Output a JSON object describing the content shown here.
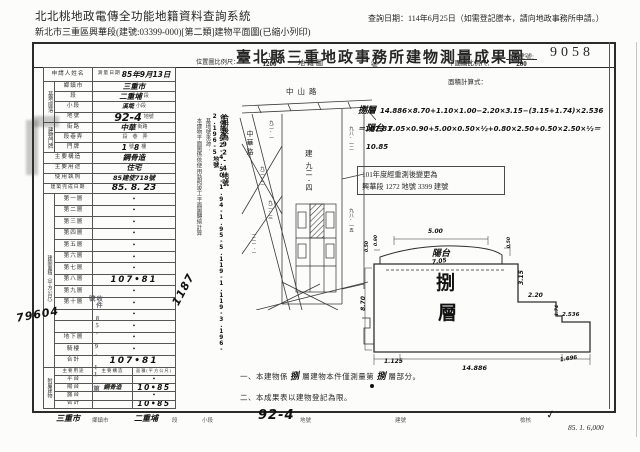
{
  "header": {
    "system_title": "北北桃地政電傳全功能地籍資料查詢系統",
    "query_date": "查詢日期：114年6月25日（如需登記謄本，請向地政事務所申請。）",
    "doc_line": "新北市三重區興華段(建號:03399-000)[第二類]建物平面圖(已縮小列印)"
  },
  "title_bar": {
    "title": "臺北縣三重地政事務所建物測量成果圖",
    "building_no_label": "建號:",
    "building_no": "9058"
  },
  "left_table": {
    "applicant_label": "申請人姓名",
    "survey_date_label": "測量日期",
    "survey_date_value": "85年9月13日",
    "site_group_label": "基地座落",
    "site_rows": [
      {
        "label": "鄉鎮市",
        "value": "三重市",
        "suffix": ""
      },
      {
        "label": "段",
        "value": "二重埔",
        "suffix": "段"
      },
      {
        "label": "小段",
        "value": "溪墘",
        "suffix": "小段"
      },
      {
        "label": "地號",
        "value": "92-4",
        "suffix": "地號"
      }
    ],
    "door_group_label": "建物門牌",
    "door_rows": [
      {
        "label": "街路",
        "value": "中華",
        "suffix": "街路"
      },
      {
        "label": "段巷弄",
        "value": "",
        "suffix": "段　巷　弄"
      },
      {
        "label": "門牌",
        "value": "1",
        "mid": "號",
        "value2": "8",
        "suffix": "樓"
      }
    ],
    "structure_label": "主要構造",
    "structure_value": "鋼骨造",
    "use_label": "主要用途",
    "use_value": "住宅",
    "license_label": "使用執照",
    "license_value": "85建使718號",
    "complete_label": "建築完成日期",
    "complete_value": "85. 8. 23",
    "area_group_label": "建築面積（平方公尺）",
    "floor_rows": [
      {
        "label": "第一層",
        "value": "•"
      },
      {
        "label": "第二層",
        "value": "•"
      },
      {
        "label": "第三層",
        "value": "•"
      },
      {
        "label": "第四層",
        "value": "•"
      },
      {
        "label": "第五層",
        "value": "•"
      },
      {
        "label": "第六層",
        "value": "•"
      },
      {
        "label": "第七層",
        "value": "•"
      },
      {
        "label": "第八層",
        "value": "107•81"
      },
      {
        "label": "第九層",
        "value": "•"
      },
      {
        "label": "第十層",
        "value": "•"
      },
      {
        "label": "",
        "value": "•"
      },
      {
        "label": "",
        "value": "•"
      },
      {
        "label": "地下層",
        "value": "•"
      },
      {
        "label": "騎樓",
        "value": "•"
      }
    ],
    "total_label": "合計",
    "total_value": "107•81",
    "annex_group_label": "附屬建物",
    "annex_headers": [
      "主要用途",
      "主要構造",
      "面積(平方公尺)"
    ],
    "annex_rows": [
      {
        "use": "平台",
        "structure": "",
        "area": "•"
      },
      {
        "use": "陽台",
        "structure": "鋼骨造",
        "area": "10•85"
      },
      {
        "use": "露台",
        "structure": "",
        "area": "•"
      },
      {
        "use": "合計",
        "structure": "",
        "area": "10•85"
      }
    ]
  },
  "notes_column": {
    "printed": "本建物平面圖係依使用執照竣工平面圖轉繪計算",
    "source_label": "基地號來源：",
    "hand_after": "合併後為92-4地號",
    "hand_before": "合併前為92-4.50-1.94-1.95-5.119-1.119-3.196-2.196-5地號"
  },
  "cadastral": {
    "scale_label": "位置圖比例尺：",
    "scale_num": "1",
    "scale_den": "1200",
    "map_type": "地籍圖",
    "road_top": "中山路",
    "road_left": "中華路",
    "center_prefix": "建",
    "center_parcel": "九二-四",
    "parcels": [
      "九二-一",
      "九二-二",
      "九二-三",
      "一二一-一",
      "九八-一二",
      "九八-一五"
    ]
  },
  "plan": {
    "no_suffix": "號",
    "scale_label": "平面圖比例尺：",
    "scale_num": "1",
    "scale_den": "200",
    "formula_label": "面積計算式：",
    "formula1_name": "捌層",
    "formula1": "14.886×8.70+1.10×1.00−2.20×3.15−(3.15+1.74)×2.536＝107.81",
    "formula2_name": "陽台",
    "formula2": "7.05×0.90+5.00×0.50×½+0.80×2.50+0.50×2.50×½＝10.85",
    "remeasure1": "101年度經重測後變更為",
    "remeasure2": "興華段 1272 地號 3399 建號",
    "floor_char1": "捌",
    "floor_char2": "層",
    "balcony": "陽台",
    "dims": {
      "top": "5.00",
      "balcony_w": "7.05",
      "balcony_d": "0.90",
      "end_l": "0.50",
      "end_r": "0.50",
      "step_v": "3.15",
      "step_h": "2.20",
      "notch_w": "2.536",
      "notch_v": "1.74",
      "height": "8.70",
      "bottom_l": "1.125",
      "bottom": "14.886",
      "bottom_r": "1.696"
    }
  },
  "notes": {
    "n1a": "一、本建物係",
    "n1h1": "捌",
    "n1b": "層建物本件僅測量第",
    "n1h2": "捌",
    "n1c": "層部分。",
    "n2": "二、本成果表以建物登記為限。"
  },
  "footer": {
    "city_hand": "三重市",
    "city_label": "鄉鎮市",
    "sec_hand": "二重埔",
    "sec_label": "段",
    "subsec_label": "小段",
    "parcel_hand": "92-4",
    "parcel_label": "地號",
    "bno_label": "建號",
    "check_label": "檢核",
    "check_hand": "✓",
    "print_info": "85. 1. 6,000"
  },
  "stamps": {
    "no1": "79604",
    "no2": "1187",
    "receipt": "收件 85. 9. 11 第　號"
  }
}
